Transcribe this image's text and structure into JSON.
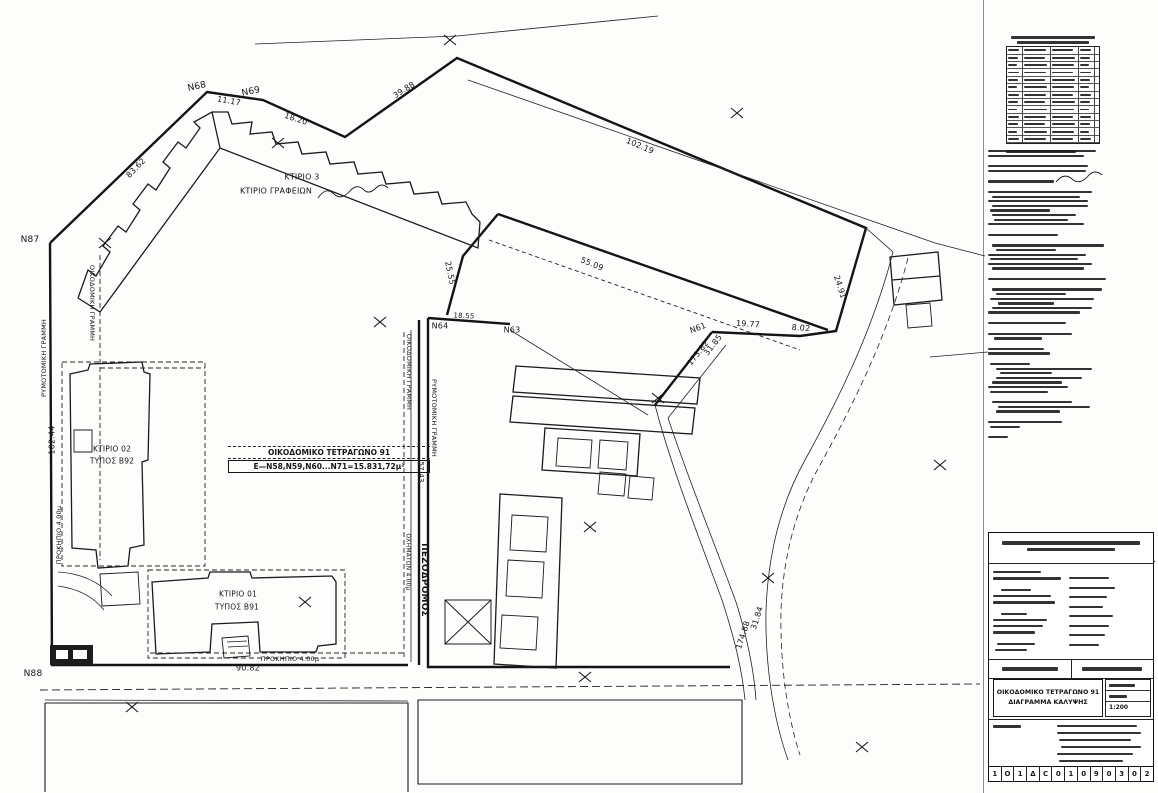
{
  "plan": {
    "block_label": {
      "line1": "ΟΙΚΟΔΟΜΙΚΟ ΤΕΤΡΑΓΩΝΟ 91",
      "line2": "Ε—Ν58,Ν59,Ν60...Ν71=15.831,72μ²"
    },
    "labels": [
      {
        "id": "point-n87",
        "t": "Ν87",
        "x": 30,
        "y": 240,
        "r": 0,
        "s": 9
      },
      {
        "id": "point-n68",
        "t": "Ν68",
        "x": 197,
        "y": 87,
        "r": -12,
        "s": 9
      },
      {
        "id": "point-n69",
        "t": "Ν69",
        "x": 251,
        "y": 92,
        "r": -12,
        "s": 9
      },
      {
        "id": "point-n88",
        "t": "Ν88",
        "x": 33,
        "y": 674,
        "r": 0,
        "s": 9
      },
      {
        "id": "point-n64",
        "t": "Ν64",
        "x": 440,
        "y": 326,
        "r": 0,
        "s": 8
      },
      {
        "id": "point-n63",
        "t": "Ν63",
        "x": 512,
        "y": 330,
        "r": 0,
        "s": 8
      },
      {
        "id": "point-n61",
        "t": "Ν61",
        "x": 698,
        "y": 328,
        "r": -20,
        "s": 8
      },
      {
        "id": "dim-83-62",
        "t": "83.62",
        "x": 136,
        "y": 168,
        "r": -46,
        "s": 8
      },
      {
        "id": "dim-11-17",
        "t": "11.17",
        "x": 229,
        "y": 101,
        "r": 10,
        "s": 8
      },
      {
        "id": "dim-18-20",
        "t": "18.20",
        "x": 296,
        "y": 119,
        "r": 18,
        "s": 8
      },
      {
        "id": "dim-39-88",
        "t": "39.88",
        "x": 404,
        "y": 90,
        "r": -32,
        "s": 8
      },
      {
        "id": "dim-102-19",
        "t": "102.19",
        "x": 640,
        "y": 146,
        "r": 23,
        "s": 8
      },
      {
        "id": "dim-24-91",
        "t": "24.91",
        "x": 840,
        "y": 287,
        "r": 72,
        "s": 8
      },
      {
        "id": "dim-55-09",
        "t": "55.09",
        "x": 592,
        "y": 264,
        "r": 22,
        "s": 8
      },
      {
        "id": "dim-25-55",
        "t": "25.55",
        "x": 450,
        "y": 273,
        "r": 78,
        "s": 8
      },
      {
        "id": "dim-18-55",
        "t": "18.55",
        "x": 464,
        "y": 316,
        "r": 3,
        "s": 7
      },
      {
        "id": "dim-19-77",
        "t": "19.77",
        "x": 748,
        "y": 324,
        "r": 4,
        "s": 8
      },
      {
        "id": "dim-8-02",
        "t": "8.02",
        "x": 801,
        "y": 328,
        "r": 4,
        "s": 8
      },
      {
        "id": "dim-31-85",
        "t": "31.85",
        "x": 713,
        "y": 345,
        "r": -52,
        "s": 8
      },
      {
        "id": "dim-173-82",
        "t": "173.82",
        "x": 698,
        "y": 353,
        "r": -52,
        "s": 8
      },
      {
        "id": "dim-31-84",
        "t": "31.84",
        "x": 757,
        "y": 618,
        "r": -72,
        "s": 8
      },
      {
        "id": "dim-174-88",
        "t": "174.88",
        "x": 743,
        "y": 635,
        "r": -72,
        "s": 8
      },
      {
        "id": "dim-90-82",
        "t": "90.82",
        "x": 248,
        "y": 668,
        "r": 0,
        "s": 8
      },
      {
        "id": "prokipio-bottom",
        "t": "ΠΡΟΚΗΠΙΟ 4.00μ",
        "x": 290,
        "y": 659,
        "r": 0,
        "s": 6.5
      },
      {
        "id": "dim-102-44",
        "t": "102.44",
        "x": 52,
        "y": 440,
        "r": -90,
        "s": 8
      },
      {
        "id": "prokipio-left",
        "t": "ΠΡΟΚΗΠΙΟ 4.00μ",
        "x": 59,
        "y": 535,
        "r": -90,
        "s": 6.5
      },
      {
        "id": "rymotomiki-left",
        "t": "ΡΥΜΟΤΟΜΙΚΗ ΓΡΑΜΜΗ",
        "x": 44,
        "y": 358,
        "r": -90,
        "s": 6.5
      },
      {
        "id": "oikodomiki-left",
        "t": "ΟΙΚΟΔΟΜΙΚΗ ΓΡΑΜΜΗ",
        "x": 92,
        "y": 303,
        "r": 90,
        "s": 6.5
      },
      {
        "id": "oikodomiki-mid",
        "t": "ΟΙΚΟΔΟΜΙΚΗ ΓΡΑΜΜΗ",
        "x": 409,
        "y": 372,
        "r": 90,
        "s": 6.5
      },
      {
        "id": "rymotomiki-mid",
        "t": "ΡΥΜΟΤΟΜΙΚΗ ΓΡΑΜΜΗ",
        "x": 434,
        "y": 418,
        "r": 90,
        "s": 6.5
      },
      {
        "id": "dim-57-43",
        "t": "57.43",
        "x": 421,
        "y": 472,
        "r": 90,
        "s": 7
      },
      {
        "id": "pezodromos",
        "t": "ΠΕΖΟΔΡΟΜΟΣ",
        "x": 424,
        "y": 580,
        "r": 90,
        "s": 9,
        "b": 1
      },
      {
        "id": "oximaton",
        "t": "ΟΧΗΜΑΤΩΝ 4.00μ",
        "x": 408,
        "y": 562,
        "r": 90,
        "s": 6
      },
      {
        "id": "ktirio3-name",
        "t": "ΚΤΙΡΙΟ 3",
        "x": 302,
        "y": 177,
        "r": 0,
        "s": 8
      },
      {
        "id": "ktirio3-type",
        "t": "ΚΤΙΡΙΟ ΓΡΑΦΕΙΩΝ",
        "x": 276,
        "y": 191,
        "r": 0,
        "s": 8
      },
      {
        "id": "ktirio02-name",
        "t": "ΚΤΙΡΙΟ 02",
        "x": 112,
        "y": 449,
        "r": 0,
        "s": 7.5
      },
      {
        "id": "ktirio02-type",
        "t": "ΤΥΠΟΣ Β92",
        "x": 112,
        "y": 461,
        "r": 0,
        "s": 7.5
      },
      {
        "id": "ktirio01-name",
        "t": "ΚΤΙΡΙΟ 01",
        "x": 238,
        "y": 594,
        "r": 0,
        "s": 7.5
      },
      {
        "id": "ktirio01-type",
        "t": "ΤΥΠΟΣ Β91",
        "x": 237,
        "y": 607,
        "r": 0,
        "s": 7.5
      }
    ],
    "cross_marks": [
      [
        450,
        40
      ],
      [
        737,
        113
      ],
      [
        278,
        143
      ],
      [
        105,
        243
      ],
      [
        380,
        322
      ],
      [
        940,
        465
      ],
      [
        768,
        578
      ],
      [
        585,
        677
      ],
      [
        132,
        707
      ],
      [
        862,
        747
      ],
      [
        305,
        602
      ],
      [
        658,
        398
      ],
      [
        590,
        527
      ]
    ]
  },
  "right_panel": {
    "coord_table": {
      "row_count": 13,
      "col_widths": [
        16,
        28,
        28,
        16
      ]
    },
    "notes_lines": [
      [
        0,
        108
      ],
      [
        0,
        96
      ],
      [
        0,
        0
      ],
      [
        0,
        100
      ],
      [
        0,
        98
      ],
      [
        0,
        0
      ],
      [
        0,
        66
      ],
      [
        0,
        0
      ],
      [
        0,
        104
      ],
      [
        4,
        88
      ],
      [
        0,
        100
      ],
      [
        4,
        96
      ],
      [
        2,
        60
      ],
      [
        4,
        84
      ],
      [
        6,
        74
      ],
      [
        0,
        96
      ],
      [
        0,
        0
      ],
      [
        0,
        70
      ],
      [
        0,
        0
      ],
      [
        4,
        112
      ],
      [
        8,
        60
      ],
      [
        0,
        98
      ],
      [
        2,
        88
      ],
      [
        0,
        104
      ],
      [
        4,
        92
      ],
      [
        0,
        0
      ],
      [
        0,
        118
      ],
      [
        0,
        0
      ],
      [
        4,
        110
      ],
      [
        8,
        70
      ],
      [
        2,
        104
      ],
      [
        10,
        56
      ],
      [
        4,
        100
      ],
      [
        0,
        92
      ],
      [
        0,
        0
      ],
      [
        0,
        78
      ],
      [
        0,
        0
      ],
      [
        0,
        84
      ],
      [
        6,
        48
      ],
      [
        0,
        0
      ],
      [
        0,
        56
      ],
      [
        0,
        62
      ],
      [
        0,
        0
      ],
      [
        2,
        40
      ],
      [
        8,
        96
      ],
      [
        12,
        52
      ],
      [
        8,
        86
      ],
      [
        4,
        70
      ],
      [
        0,
        80
      ],
      [
        2,
        58
      ],
      [
        0,
        0
      ],
      [
        4,
        80
      ],
      [
        10,
        92
      ],
      [
        8,
        64
      ],
      [
        0,
        0
      ],
      [
        0,
        74
      ],
      [
        2,
        30
      ],
      [
        0,
        0
      ],
      [
        0,
        20
      ]
    ],
    "title_block": {
      "body_lines_left": [
        [
          4,
          48
        ],
        [
          4,
          68
        ],
        [
          -1,
          0
        ],
        [
          12,
          30
        ],
        [
          4,
          58
        ],
        [
          4,
          62
        ],
        [
          -1,
          0
        ],
        [
          12,
          26
        ],
        [
          4,
          54
        ],
        [
          4,
          50
        ],
        [
          4,
          42
        ],
        [
          -1,
          0
        ],
        [
          8,
          38
        ],
        [
          6,
          32
        ]
      ],
      "body_lines_right": [
        [
          80,
          40
        ],
        [
          80,
          46
        ],
        [
          80,
          38
        ],
        [
          80,
          34
        ],
        [
          80,
          44
        ],
        [
          80,
          40
        ],
        [
          80,
          36
        ],
        [
          80,
          30
        ]
      ],
      "notes_lines": [
        [
          68,
          80
        ],
        [
          68,
          84
        ],
        [
          70,
          72
        ],
        [
          72,
          80
        ],
        [
          68,
          76
        ],
        [
          70,
          64
        ]
      ],
      "project_line1": "ΟΙΚΟΔΟΜΙΚΟ ΤΕΤΡΑΓΩΝΟ 91",
      "project_line2": "ΔΙΑΓΡΑΜΜΑ ΚΑΛΥΨΗΣ",
      "scale_value": "1:200",
      "code_cells": [
        "1",
        "Ο",
        "1",
        "Δ",
        "C",
        "0",
        "1",
        "0",
        "9",
        "0",
        "3",
        "0",
        "2"
      ]
    }
  }
}
